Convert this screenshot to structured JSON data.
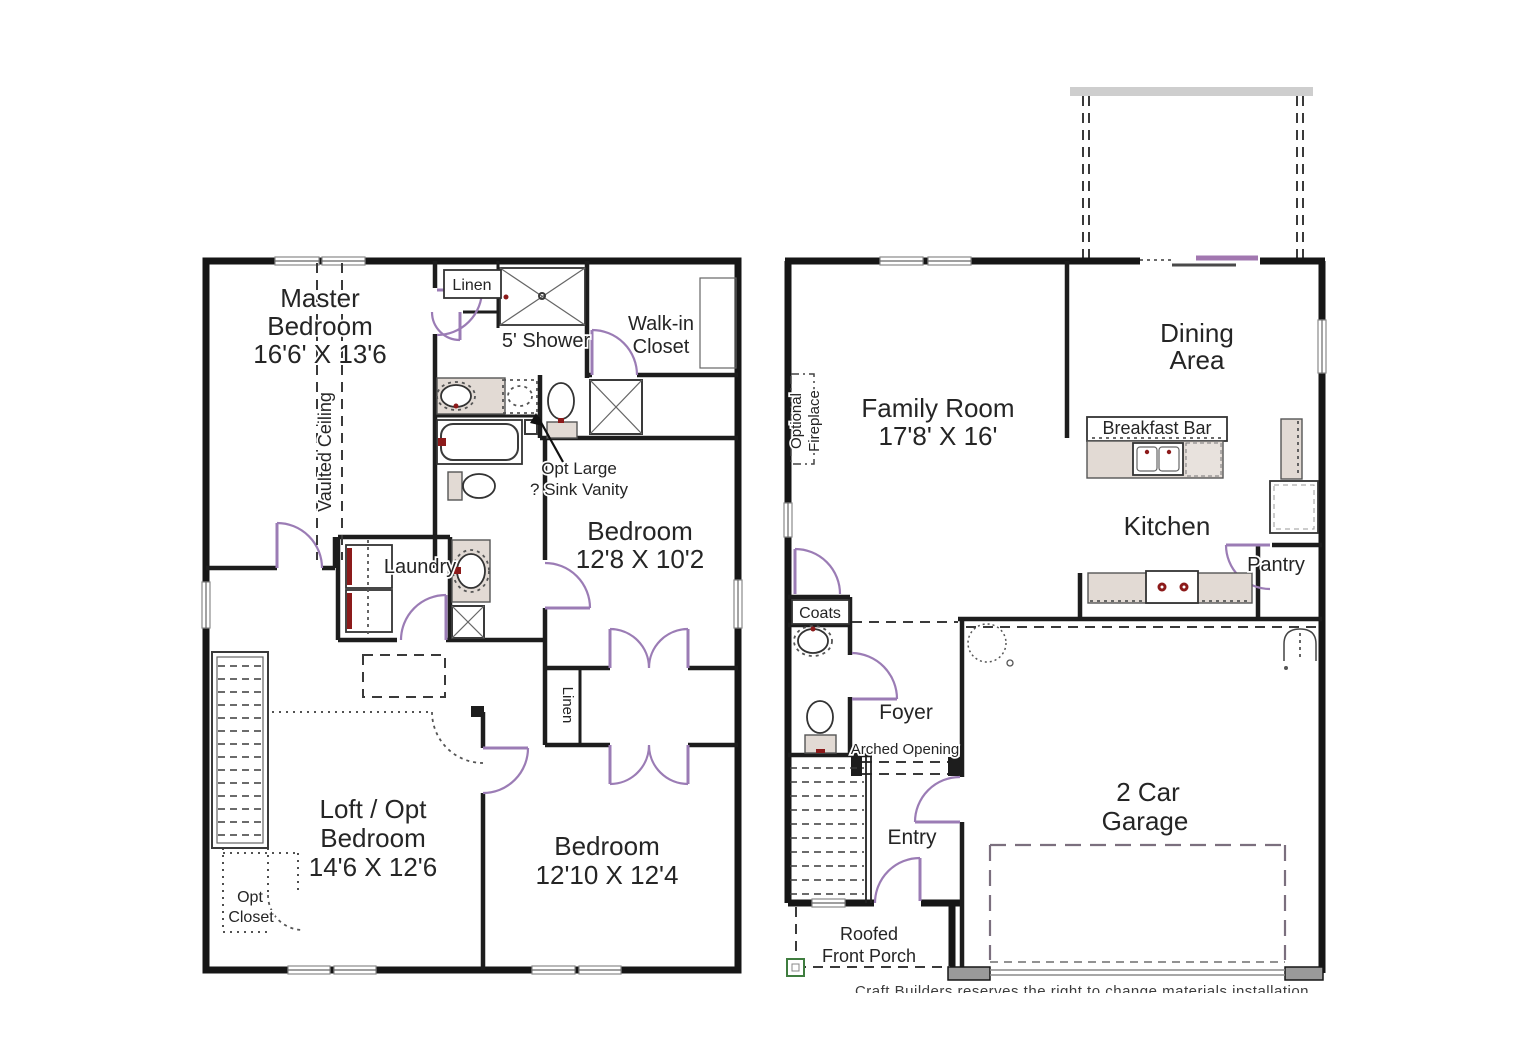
{
  "colors": {
    "wall": "#161616",
    "door_swing": "#9b7cb5",
    "fixture_fill": "#e2dad4",
    "accent_red": "#8c1a1a",
    "porch_post_green": "#3f7d3f",
    "deck_gray": "#cecece"
  },
  "second_floor": {
    "labels": {
      "master_line1": "Master",
      "master_line2": "Bedroom",
      "master_dims": "16'6' X 13'6",
      "vaulted_ceiling": "Vaulted Ceiling",
      "linen_top": "Linen",
      "shower": "5' Shower",
      "walkin_line1": "Walk-in",
      "walkin_line2": "Closet",
      "opt_vanity_line1": "Opt Large",
      "opt_vanity_line2": "? Sink Vanity",
      "laundry": "Laundry",
      "bedroom1_line1": "Bedroom",
      "bedroom1_dims": "12'8 X 10'2",
      "linen_mid": "Linen",
      "loft_line1": "Loft / Opt",
      "loft_line2": "Bedroom",
      "loft_dims": "14'6 X 12'6",
      "bedroom2_line1": "Bedroom",
      "bedroom2_dims": "12'10 X 12'4",
      "opt_closet_line1": "Opt",
      "opt_closet_line2": "Closet"
    }
  },
  "first_floor": {
    "labels": {
      "family_line1": "Family Room",
      "family_dims": "17'8' X 16'",
      "dining_line1": "Dining",
      "dining_line2": "Area",
      "breakfast_bar": "Breakfast Bar",
      "kitchen": "Kitchen",
      "pantry": "Pantry",
      "fireplace_line1": "Optional",
      "fireplace_line2": "Fireplace",
      "coats": "Coats",
      "foyer": "Foyer",
      "arched_opening": "Arched Opening",
      "entry": "Entry",
      "garage_line1": "2 Car",
      "garage_line2": "Garage",
      "porch_line1": "Roofed",
      "porch_line2": "Front Porch"
    }
  },
  "footer": {
    "caption": "Craft Builders reserves the right to change materials installation"
  }
}
